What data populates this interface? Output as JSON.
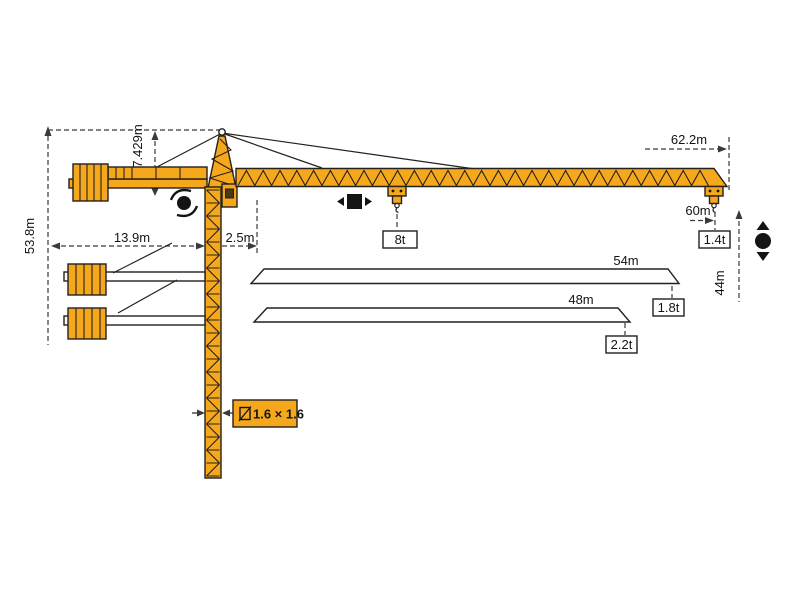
{
  "diagram_type": "tower-crane-dimension-diagram",
  "dims": {
    "total_height": "53.8m",
    "tower_head": "7.429m",
    "counter_jib": "13.9m",
    "rear_offset": "2.5m",
    "max_jib": "62.2m",
    "max_radius": "60m",
    "under_hook": "44m",
    "mast_section": "1.6 × 1.6"
  },
  "loads": {
    "max": "8t",
    "tip_max_jib": "1.4t"
  },
  "jib_options": [
    {
      "length": "54m",
      "tip_load": "1.8t"
    },
    {
      "length": "48m",
      "tip_load": "2.2t"
    }
  ],
  "icons": [
    "slew-rotation-icon",
    "trolley-travel-icon",
    "hoist-icon",
    "square-section-icon"
  ],
  "colors": {
    "crane": "#F6A81C",
    "outline": "#24201b",
    "dim": "#3a3a3a",
    "background": "#ffffff"
  }
}
